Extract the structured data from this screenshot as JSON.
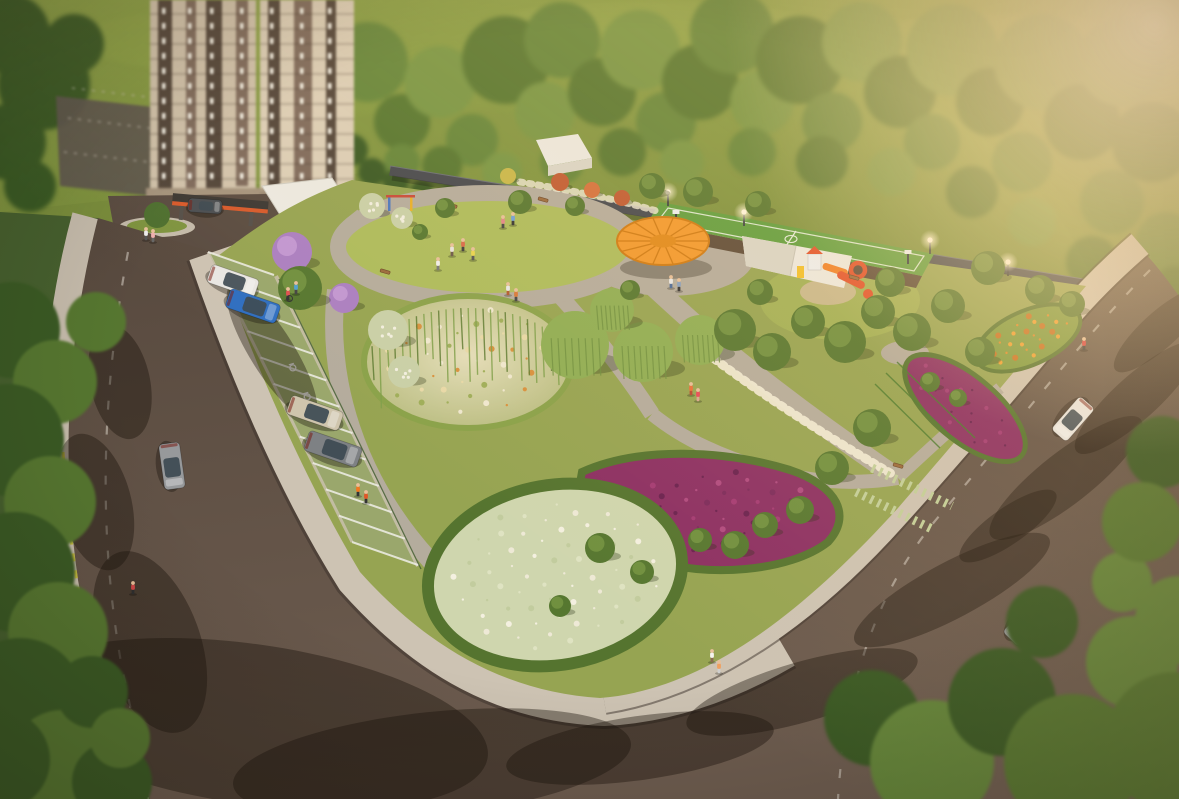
{
  "scene": {
    "meta": {
      "image_type": "3d-architectural-aerial-render",
      "subject": "residential park with parking bay, pergola, sports court, playground, flower beds and surrounding streets"
    },
    "palette": {
      "sky": "#b6d9e6",
      "hillTop": "#8aa045",
      "hillBot": "#7a8e3c",
      "forestDark": "#3a5a24",
      "forest1": "#567730",
      "forest2": "#64863a",
      "forest3": "#779644",
      "forest4": "#88a34c",
      "park": "#96a452",
      "lawn": "#adbc5c",
      "lawn2": "#a2b156",
      "path": "#b4ac9d",
      "sidewalk": "#cdc3b3",
      "sidewalk2": "#c6bcac",
      "road": "#5d4e43",
      "curb": "#39302a",
      "wall": "#45484e",
      "wallTop": "#6a6e76",
      "beige": "#d2c4ad",
      "beige2": "#dccfb8",
      "bldgDark": "#52453a",
      "bldgBrown": "#7e6a5c",
      "windowc": "#f6f3e9",
      "basec": "#a5947e",
      "lot": "#5e574e",
      "white": "#eceae2",
      "whiteShade": "#d9d6c9",
      "pergola": "#f2992d",
      "pergolaDark": "#cf7a12",
      "court": "#5f9e3e",
      "courtLine": "#e9efe0",
      "dirt": "#5c4a38",
      "playO": "#f08026",
      "playR": "#e2502a",
      "playY": "#f2c12e",
      "playW": "#eef0f2",
      "purple": "#8c2f63",
      "bedRing": "#55742f",
      "sage": "#cfd6ae",
      "mound1": "#e7e0bd",
      "mound2": "#b9bd82",
      "lilac": "#ab7fc2",
      "lilacHi": "#c59bd6",
      "shrubW": "#c9d0a8",
      "bloomW": "#efe9d4",
      "willow": "#8fae54",
      "willowDk": "#6f9040",
      "hedgeOr": "#7d9a3e",
      "yellow": "#cdc12c",
      "island": "#7e9440",
      "skin": "#e8c09a",
      "canopyDk": "#3c3834",
      "canopyAc": "#d85a2c",
      "glassc": "#3d4a52",
      "stall": "#9aa76c",
      "laneDash": "#d8d2c6",
      "shadow": "rgba(25,18,10,0.40)",
      "treeShad": "rgba(35,45,18,0.30)"
    },
    "forest_trees": [
      [
        10,
        34,
        40,
        0
      ],
      [
        44,
        84,
        46,
        0
      ],
      [
        8,
        142,
        38,
        0
      ],
      [
        74,
        44,
        30,
        0
      ],
      [
        30,
        186,
        26,
        0
      ],
      [
        368,
        62,
        40,
        2
      ],
      [
        402,
        122,
        28,
        1
      ],
      [
        440,
        82,
        36,
        3
      ],
      [
        472,
        140,
        26,
        2
      ],
      [
        506,
        60,
        44,
        1
      ],
      [
        545,
        112,
        30,
        3
      ],
      [
        562,
        40,
        38,
        2
      ],
      [
        602,
        92,
        34,
        1
      ],
      [
        640,
        50,
        40,
        3
      ],
      [
        666,
        122,
        30,
        2
      ],
      [
        700,
        82,
        38,
        1
      ],
      [
        732,
        32,
        42,
        2
      ],
      [
        762,
        102,
        32,
        3
      ],
      [
        800,
        60,
        44,
        1
      ],
      [
        832,
        122,
        30,
        2
      ],
      [
        862,
        42,
        40,
        3
      ],
      [
        900,
        92,
        36,
        1
      ],
      [
        932,
        142,
        28,
        2
      ],
      [
        952,
        50,
        46,
        3
      ],
      [
        990,
        102,
        34,
        1
      ],
      [
        1022,
        162,
        30,
        2
      ],
      [
        1042,
        62,
        48,
        3
      ],
      [
        1082,
        122,
        38,
        1
      ],
      [
        1112,
        202,
        32,
        2
      ],
      [
        1122,
        62,
        44,
        3
      ],
      [
        1152,
        142,
        40,
        1
      ],
      [
        1166,
        242,
        30,
        2
      ],
      [
        1092,
        262,
        26,
        1
      ],
      [
        1032,
        222,
        24,
        3
      ],
      [
        972,
        192,
        26,
        1
      ],
      [
        892,
        172,
        24,
        3
      ],
      [
        822,
        162,
        26,
        1
      ],
      [
        752,
        152,
        24,
        2
      ],
      [
        682,
        162,
        22,
        3
      ],
      [
        622,
        152,
        24,
        1
      ],
      [
        562,
        162,
        22,
        2
      ],
      [
        502,
        172,
        20,
        3
      ],
      [
        442,
        166,
        20,
        1
      ],
      [
        402,
        162,
        18,
        2
      ],
      [
        1175,
        290,
        24,
        1
      ],
      [
        352,
        150,
        16,
        0
      ],
      [
        372,
        172,
        14,
        0
      ],
      [
        396,
        182,
        13,
        0
      ],
      [
        422,
        192,
        12,
        0
      ],
      [
        452,
        197,
        12,
        0
      ],
      [
        482,
        202,
        11,
        0
      ]
    ],
    "edge_trees": [
      [
        12,
        330,
        48
      ],
      [
        55,
        382,
        42
      ],
      [
        8,
        440,
        56
      ],
      [
        50,
        502,
        46
      ],
      [
        15,
        572,
        60
      ],
      [
        58,
        632,
        50
      ],
      [
        20,
        702,
        64
      ],
      [
        62,
        762,
        52
      ],
      [
        112,
        782,
        40
      ],
      [
        96,
        322,
        30
      ],
      [
        92,
        692,
        36
      ],
      [
        120,
        738,
        30
      ],
      [
        0,
        760,
        50
      ]
    ],
    "corner_trees": [
      [
        872,
        718,
        48
      ],
      [
        932,
        762,
        62
      ],
      [
        1002,
        702,
        54
      ],
      [
        1072,
        762,
        68
      ],
      [
        1132,
        662,
        46
      ],
      [
        1175,
        742,
        70
      ],
      [
        1042,
        622,
        36
      ],
      [
        1122,
        582,
        30
      ],
      [
        1162,
        452,
        36
      ],
      [
        1142,
        522,
        40
      ],
      [
        1179,
        620,
        44
      ]
    ],
    "park_trees": [
      [
        292,
        252,
        20,
        "l"
      ],
      [
        344,
        298,
        15,
        "l"
      ],
      [
        300,
        288,
        22,
        "g"
      ],
      [
        445,
        208,
        10,
        "g"
      ],
      [
        520,
        202,
        12,
        "g"
      ],
      [
        575,
        206,
        10,
        "g"
      ],
      [
        420,
        232,
        8,
        "g"
      ],
      [
        652,
        186,
        13,
        "g"
      ],
      [
        698,
        192,
        15,
        "g"
      ],
      [
        758,
        204,
        13,
        "g"
      ],
      [
        988,
        268,
        17,
        "g"
      ],
      [
        1040,
        290,
        15,
        "g"
      ],
      [
        1072,
        304,
        13,
        "g"
      ],
      [
        575,
        345,
        34,
        "w"
      ],
      [
        643,
        352,
        30,
        "w"
      ],
      [
        612,
        310,
        22,
        "w"
      ],
      [
        700,
        340,
        25,
        "w"
      ],
      [
        735,
        330,
        21,
        "g"
      ],
      [
        772,
        352,
        19,
        "g"
      ],
      [
        808,
        322,
        17,
        "g"
      ],
      [
        845,
        342,
        21,
        "g"
      ],
      [
        878,
        312,
        17,
        "g"
      ],
      [
        912,
        332,
        19,
        "g"
      ],
      [
        948,
        306,
        17,
        "g"
      ],
      [
        980,
        352,
        15,
        "g"
      ],
      [
        872,
        428,
        19,
        "g"
      ],
      [
        832,
        468,
        17,
        "g"
      ],
      [
        735,
        545,
        14,
        "g"
      ],
      [
        765,
        525,
        13,
        "g"
      ],
      [
        700,
        540,
        12,
        "g"
      ],
      [
        800,
        510,
        14,
        "g"
      ],
      [
        600,
        548,
        15,
        "g"
      ],
      [
        642,
        572,
        12,
        "g"
      ],
      [
        560,
        606,
        11,
        "g"
      ],
      [
        760,
        292,
        13,
        "g"
      ],
      [
        890,
        282,
        15,
        "g"
      ],
      [
        630,
        290,
        10,
        "g"
      ],
      [
        388,
        330,
        20,
        "s"
      ],
      [
        404,
        372,
        16,
        "s"
      ],
      [
        372,
        206,
        13,
        "s"
      ],
      [
        402,
        218,
        11,
        "s"
      ],
      [
        560,
        182,
        9,
        "r"
      ],
      [
        592,
        190,
        8,
        "r2"
      ],
      [
        622,
        198,
        8,
        "r"
      ],
      [
        508,
        176,
        8,
        "y"
      ],
      [
        930,
        382,
        10,
        "g"
      ],
      [
        958,
        398,
        9,
        "g"
      ]
    ],
    "benches": [
      [
        385,
        272
      ],
      [
        452,
        206
      ],
      [
        543,
        200
      ],
      [
        618,
        292
      ],
      [
        854,
        278
      ],
      [
        898,
        466
      ]
    ],
    "parking": {
      "a": [
        208,
        252
      ],
      "b": [
        352,
        542
      ],
      "depth": [
        66,
        23
      ],
      "stalls": 12,
      "accessible_ts": [
        0.36,
        0.46
      ]
    },
    "parked_cars": [
      [
        233,
        281,
        19,
        50,
        19,
        "#e9e7e3"
      ],
      [
        253,
        306,
        19,
        53,
        20,
        "#2f6fc1"
      ],
      [
        315,
        413,
        19,
        55,
        20,
        "#cfc5ad"
      ],
      [
        333,
        449,
        19,
        56,
        21,
        "#7e8184"
      ]
    ],
    "road_cars": [
      [
        172,
        466,
        82,
        46,
        21,
        "#97999b"
      ],
      [
        1073,
        419,
        131,
        44,
        20,
        "#e9e7e3"
      ],
      [
        1027,
        622,
        134,
        48,
        22,
        "#9a9c9e"
      ],
      [
        205,
        206,
        4,
        34,
        14,
        "#4a4e52"
      ]
    ],
    "people": [
      [
        452,
        252,
        "#e8e4de",
        "#6b5a4a"
      ],
      [
        463,
        247,
        "#d86a4a",
        "#3d3d3d"
      ],
      [
        473,
        256,
        "#e8d44f",
        "#555555"
      ],
      [
        438,
        266,
        "#f0efec",
        "#777777"
      ],
      [
        503,
        224,
        "#e08888",
        "#444444"
      ],
      [
        513,
        221,
        "#6fa0d8",
        "#333333"
      ],
      [
        508,
        291,
        "#e8e8e8",
        "#b05a30"
      ],
      [
        516,
        297,
        "#d87a3a",
        "#444444"
      ],
      [
        712,
        658,
        "#f6f4f0",
        "#8a6a50"
      ],
      [
        719,
        669,
        "#f0a060",
        "#cfcfcf"
      ],
      [
        1084,
        346,
        "#d84040",
        "#3a3a3a"
      ],
      [
        288,
        296,
        "#e05050",
        "#333333"
      ],
      [
        296,
        290,
        "#50a0d0",
        "#444444"
      ],
      [
        358,
        492,
        "#f07820",
        "#333333"
      ],
      [
        366,
        499,
        "#e05828",
        "#333333"
      ],
      [
        133,
        590,
        "#d04848",
        "#2e2e2e"
      ],
      [
        146,
        236,
        "#eeeeee",
        "#555555"
      ],
      [
        153,
        238,
        "#f0b0b0",
        "#666666"
      ],
      [
        671,
        284,
        "#e8e8e8",
        "#4a6a9a"
      ],
      [
        679,
        287,
        "#88a0c0",
        "#333333"
      ],
      [
        691,
        391,
        "#e8703a",
        "#b84830"
      ],
      [
        698,
        397,
        "#e84858",
        "#d8a890"
      ]
    ],
    "shadows": [
      [
        640,
        748,
        135,
        32,
        -8
      ],
      [
        802,
        692,
        120,
        30,
        -16
      ],
      [
        952,
        590,
        110,
        28,
        -28
      ],
      [
        1066,
        478,
        95,
        26,
        -38
      ],
      [
        1136,
        398,
        80,
        22,
        -42
      ],
      [
        432,
        764,
        200,
        52,
        -6
      ],
      [
        150,
        642,
        95,
        50,
        70
      ],
      [
        95,
        502,
        70,
        36,
        75
      ],
      [
        120,
        382,
        58,
        30,
        78
      ],
      [
        1008,
        526,
        58,
        18,
        -35
      ],
      [
        272,
        352,
        78,
        22,
        58
      ],
      [
        1160,
        330,
        60,
        18,
        -42
      ],
      [
        250,
        724,
        240,
        80,
        8
      ]
    ],
    "towers": [
      {
        "x": 150,
        "w": 106,
        "h": 194,
        "cols": [
          12,
          38,
          60,
          90
        ]
      },
      {
        "x": 260,
        "w": 94,
        "h": 206,
        "cols": [
          10,
          40,
          68
        ]
      }
    ],
    "back_lot_lines": [
      [
        68,
        118,
        246,
        140
      ],
      [
        64,
        152,
        250,
        174
      ],
      [
        72,
        88,
        240,
        108
      ]
    ],
    "beds": {
      "mound": {
        "cx": 468,
        "cy": 362,
        "rx": 96,
        "ry": 58,
        "rot": -8,
        "n": 48,
        "colors": [
          "#efe8d0",
          "#d8913e",
          "#e8d9a8",
          "#9fae5a"
        ]
      },
      "white": {
        "cx": 555,
        "cy": 575,
        "rx": 116,
        "ry": 80,
        "rot": -10,
        "n": 64,
        "colors": [
          "#eee9d6",
          "#dfe3c2",
          "#c2cc9e",
          "#f4f0e0"
        ]
      },
      "purple": {
        "cx": 706,
        "cy": 512,
        "rx": 110,
        "ry": 44,
        "rot": -6,
        "n": 48,
        "colors": [
          "#6a2150",
          "#a43a74",
          "#7c2a5c",
          "#b04a80"
        ]
      },
      "band": {
        "cx": 965,
        "cy": 408,
        "rx": 66,
        "ry": 26,
        "rot": 40,
        "n": 26,
        "colors": [
          "#6a2150",
          "#a43a74",
          "#8c2f63"
        ]
      },
      "orange": {
        "cx": 1028,
        "cy": 338,
        "rx": 48,
        "ry": 22,
        "rot": -24,
        "n": 24,
        "colors": [
          "#e08a28",
          "#f0a030",
          "#c87020"
        ]
      }
    },
    "pergola": {
      "cx": 663,
      "cy": 241,
      "rx": 46,
      "ry": 24,
      "slats": 14
    },
    "lights": [
      [
        668,
        192
      ],
      [
        744,
        212
      ],
      [
        930,
        240
      ],
      [
        1008,
        262
      ]
    ],
    "hoops": [
      [
        676,
        214
      ],
      [
        908,
        254
      ]
    ]
  }
}
